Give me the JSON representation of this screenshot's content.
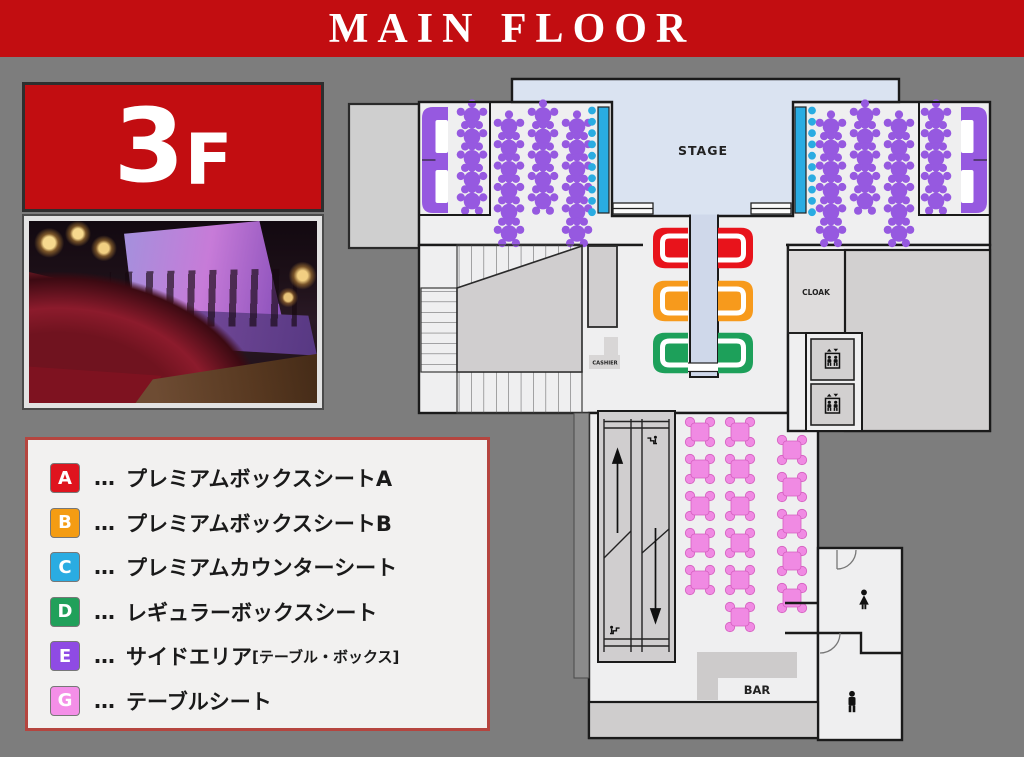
{
  "banner": {
    "title": "MAIN FLOOR"
  },
  "floor_card": {
    "number": "3",
    "suffix": "F"
  },
  "legend": {
    "separator": "…",
    "items": [
      {
        "key": "A",
        "color": "#df141e",
        "text": "プレミアムボックスシートA"
      },
      {
        "key": "B",
        "color": "#f49c13",
        "text": "プレミアムボックスシートB"
      },
      {
        "key": "C",
        "color": "#2aace2",
        "text": "プレミアムカウンターシート"
      },
      {
        "key": "D",
        "color": "#21a05a",
        "text": "レギュラーボックスシート"
      },
      {
        "key": "E",
        "color": "#8f4be4",
        "text": "サイドエリア",
        "subtext": "[テーブル・ボックス]"
      },
      {
        "key": "G",
        "color": "#f48fe8",
        "text": "テーブルシート"
      }
    ]
  },
  "map": {
    "labels": {
      "stage": "STAGE",
      "cloak": "CLOAK",
      "cashier": "CASHIER",
      "bar": "BAR"
    },
    "colors": {
      "seat_a": "#e8131b",
      "seat_b": "#f79a1c",
      "seat_c": "#2aace2",
      "seat_d": "#1da05a",
      "seat_e": "#9659e0",
      "seat_g": "#f08ae3",
      "stage": "#dae3f1",
      "runway": "#cfd8ea"
    }
  }
}
